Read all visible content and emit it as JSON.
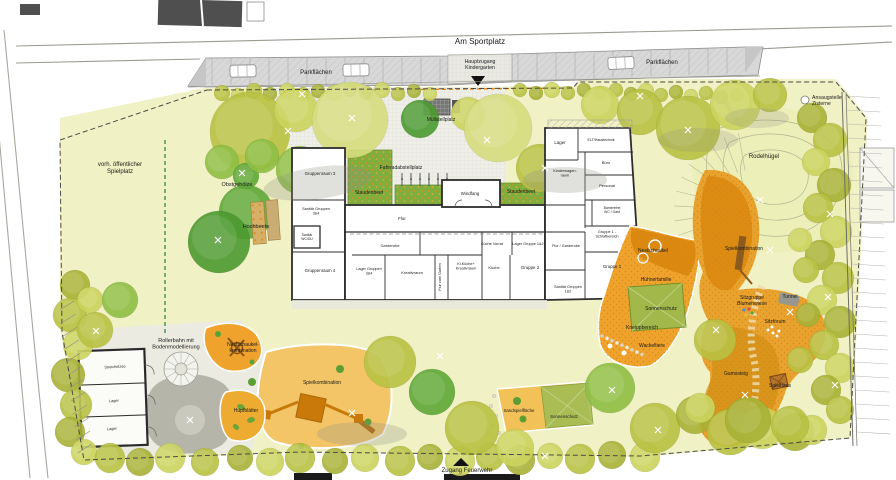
{
  "plan_title": "Kindergarten Freianlagen Lageplan",
  "colors": {
    "ground": "#f0f1c4",
    "terrace": "#efefe9",
    "parking": "#d8d8d8",
    "sand_light": "#f3c567",
    "play_orange": "#e9a22e",
    "structure_orange": "#c8790a",
    "canopy_green": "#9dba4d",
    "bed_green": "#7fae3f",
    "building_wall": "#2e2e2e",
    "hill_ground": "#edefb8",
    "boundary_dash": "#4c4c46"
  },
  "labels": [
    {
      "id": "street-name",
      "text": "Am Sportplatz",
      "x": 480,
      "y": 44,
      "fs": 8
    },
    {
      "id": "parking-left",
      "text": "Parkflächen",
      "x": 316,
      "y": 74,
      "fs": 6
    },
    {
      "id": "parking-right",
      "text": "Parkflächen",
      "x": 662,
      "y": 64,
      "fs": 6
    },
    {
      "id": "main-entrance",
      "text": "Hauptzugang\nKindergarten",
      "x": 480,
      "y": 63,
      "fs": 5.2
    },
    {
      "id": "cistern",
      "text": "Ansaugstelle\nZisterne",
      "x": 812,
      "y": 99,
      "fs": 5.2,
      "anchor": "start"
    },
    {
      "id": "public-playground",
      "text": "vorh. öffentlicher\nSpielplatz",
      "x": 120,
      "y": 166,
      "fs": 6
    },
    {
      "id": "orchard",
      "text": "Obstgehölze",
      "x": 237,
      "y": 186,
      "fs": 5.5
    },
    {
      "id": "raised-beds",
      "text": "Hochbeete",
      "x": 256,
      "y": 228,
      "fs": 5.5
    },
    {
      "id": "waste-area",
      "text": "Müllstellplatz",
      "x": 441,
      "y": 121,
      "fs": 5
    },
    {
      "id": "bike-parking",
      "text": "Fahrradabstellplatz",
      "x": 401,
      "y": 169,
      "fs": 5
    },
    {
      "id": "perennial-bed-left",
      "text": "Staudenbeet",
      "x": 369,
      "y": 194,
      "fs": 5,
      "color": "#a96b07"
    },
    {
      "id": "perennial-bed-right",
      "text": "Staudenbeet",
      "x": 521,
      "y": 193,
      "fs": 5,
      "color": "#a96b07"
    },
    {
      "id": "windbreak",
      "text": "Windfang",
      "x": 470,
      "y": 195,
      "fs": 4.4
    },
    {
      "id": "group-room-3",
      "text": "Gruppenraum 3",
      "x": 320,
      "y": 175,
      "fs": 4.4
    },
    {
      "id": "sanitary-34",
      "text": "Sanitär Gruppen\n3&4",
      "x": 316,
      "y": 210,
      "fs": 3.8
    },
    {
      "id": "sanitary-wc",
      "text": "Sanitär\nWC/DU",
      "x": 307,
      "y": 236,
      "fs": 3.4
    },
    {
      "id": "group-room-4",
      "text": "Gruppenraum 4",
      "x": 320,
      "y": 272,
      "fs": 4.4
    },
    {
      "id": "storage-34",
      "text": "Lager Gruppen\n3&4",
      "x": 369,
      "y": 270,
      "fs": 3.8
    },
    {
      "id": "corridor",
      "text": "Flur",
      "x": 402,
      "y": 220,
      "fs": 4.4
    },
    {
      "id": "cloakroom",
      "text": "Garderobe",
      "x": 390,
      "y": 247,
      "fs": 4
    },
    {
      "id": "creative-room",
      "text": "Kreativraum",
      "x": 412,
      "y": 274,
      "fs": 4
    },
    {
      "id": "corridor-garden",
      "text": "Flur zum Garten",
      "x": 441,
      "y": 277,
      "fs": 3.8,
      "rot": -90
    },
    {
      "id": "small-kitchen",
      "text": "Kl.Küche+\nKreativraum",
      "x": 466,
      "y": 265,
      "fs": 3.8
    },
    {
      "id": "kitchen-pantry",
      "text": "Küche Vorrat",
      "x": 492,
      "y": 245,
      "fs": 3.8
    },
    {
      "id": "kitchen",
      "text": "Küche",
      "x": 494,
      "y": 269,
      "fs": 4
    },
    {
      "id": "storage-12",
      "text": "Lager Gruppe 1&2",
      "x": 528,
      "y": 245,
      "fs": 3.8
    },
    {
      "id": "group-2",
      "text": "Gruppe 2",
      "x": 530,
      "y": 269,
      "fs": 4.4
    },
    {
      "id": "sanitary-12",
      "text": "Sanitär Gruppen\n1&2",
      "x": 568,
      "y": 288,
      "fs": 3.8
    },
    {
      "id": "corridor-cloakroom",
      "text": "Flur / Garderobe",
      "x": 566,
      "y": 247,
      "fs": 3.8
    },
    {
      "id": "group1-sleep",
      "text": "Gruppe 1 -\nSchlafbereich",
      "x": 607,
      "y": 233,
      "fs": 3.8
    },
    {
      "id": "group-1",
      "text": "Gruppe 1",
      "x": 612,
      "y": 268,
      "fs": 4.4
    },
    {
      "id": "storage-right",
      "text": "Lager",
      "x": 560,
      "y": 144,
      "fs": 4.4
    },
    {
      "id": "building-services",
      "text": "ELT/Haustechnik",
      "x": 601,
      "y": 141,
      "fs": 3.6
    },
    {
      "id": "pram-room",
      "text": "Kinderwagen-\nraum",
      "x": 565,
      "y": 172,
      "fs": 3.8
    },
    {
      "id": "office",
      "text": "Büro",
      "x": 606,
      "y": 164,
      "fs": 4
    },
    {
      "id": "staff-room",
      "text": "Personal",
      "x": 607,
      "y": 187,
      "fs": 4
    },
    {
      "id": "accessible-wc",
      "text": "Barrierefrei\nWC / Gast",
      "x": 612,
      "y": 209,
      "fs": 3.4
    },
    {
      "id": "sledding-hill",
      "text": "Rodelhügel",
      "x": 764,
      "y": 158,
      "fs": 6
    },
    {
      "id": "play-combo-right",
      "text": "Spielkombination",
      "x": 744,
      "y": 250,
      "fs": 5,
      "color": "#fffdf2"
    },
    {
      "id": "nest-swing",
      "text": "Nestschaukel",
      "x": 653,
      "y": 252,
      "fs": 5,
      "color": "#fffdf2"
    },
    {
      "id": "chicken-family",
      "text": "Hühnerfamilie",
      "x": 656,
      "y": 281,
      "fs": 5,
      "color": "#fffdf2"
    },
    {
      "id": "sun-shade-right",
      "text": "Sonnenschutz",
      "x": 661,
      "y": 310,
      "fs": 5,
      "color": "#fffdf2"
    },
    {
      "id": "kneipp-area",
      "text": "Kneippbereich",
      "x": 642,
      "y": 329,
      "fs": 5,
      "color": "#fffdf2"
    },
    {
      "id": "wobble-animals",
      "text": "Wackeltiere",
      "x": 652,
      "y": 347,
      "fs": 5,
      "color": "#fffdf2"
    },
    {
      "id": "seating-meadow",
      "text": "Sitzgruppe\nBlumenwiese",
      "x": 752,
      "y": 299,
      "fs": 5,
      "color": "#fffdf2"
    },
    {
      "id": "tunnel",
      "text": "Tunnel",
      "x": 790,
      "y": 298,
      "fs": 5,
      "color": "#fffdf2"
    },
    {
      "id": "seating-forum",
      "text": "Sitzforum",
      "x": 775,
      "y": 323,
      "fs": 5,
      "color": "#fffdf2"
    },
    {
      "id": "mountain-trail",
      "text": "Gamssteig",
      "x": 736,
      "y": 375,
      "fs": 5,
      "color": "#fffdf2"
    },
    {
      "id": "play-house",
      "text": "Spielhaus",
      "x": 780,
      "y": 387,
      "fs": 5,
      "color": "#fffdf2"
    },
    {
      "id": "roller-track",
      "text": "Rollerbahn mit\nBodenmodellierung",
      "x": 176,
      "y": 342,
      "fs": 5.5
    },
    {
      "id": "nest-swing-combo",
      "text": "Nestschaukel-\nkombination",
      "x": 243,
      "y": 346,
      "fs": 5,
      "color": "#fffdf2"
    },
    {
      "id": "petting-zoo",
      "text": "Streichelzoo",
      "x": 115,
      "y": 368,
      "fs": 3.8,
      "rot": -3
    },
    {
      "id": "shed-storage-1",
      "text": "Lager",
      "x": 114,
      "y": 402,
      "fs": 3.8,
      "rot": -3
    },
    {
      "id": "shed-storage-2",
      "text": "Lager",
      "x": 112,
      "y": 430,
      "fs": 3.8,
      "rot": -3
    },
    {
      "id": "hop-leaves",
      "text": "Hüpfblätter",
      "x": 246,
      "y": 412,
      "fs": 5,
      "color": "#fffdf2"
    },
    {
      "id": "play-combo-bottom",
      "text": "Spielkombination",
      "x": 322,
      "y": 384,
      "fs": 5
    },
    {
      "id": "sand-play-area",
      "text": "Sandspielfläche",
      "x": 519,
      "y": 412,
      "fs": 4.4
    },
    {
      "id": "sun-shade-bottom",
      "text": "Sonnenschutz",
      "x": 564,
      "y": 418,
      "fs": 4.4
    },
    {
      "id": "fire-access",
      "text": "Zugang Feuerwehr",
      "x": 467,
      "y": 472,
      "fs": 6
    }
  ]
}
